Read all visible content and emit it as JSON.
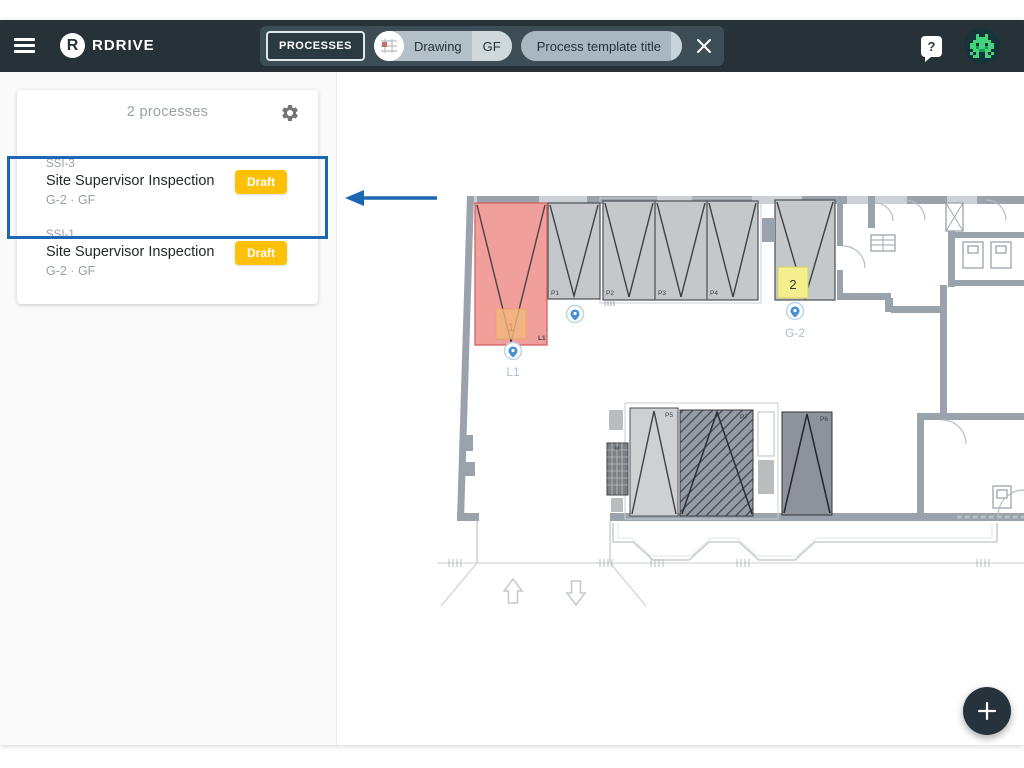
{
  "topbar": {
    "brand": "RDRIVE",
    "brand_initial": "R",
    "processes_button_label": "PROCESSES",
    "drawing_chip": {
      "label": "Drawing",
      "floor": "GF"
    },
    "template_chip": {
      "label": "Process template title"
    },
    "help_glyph": "?"
  },
  "sidebar": {
    "header": {
      "count_label": "2 processes"
    },
    "items": [
      {
        "code": "SSI-3",
        "title": "Site Supervisor Inspection",
        "status": "Draft",
        "location": "G-2 · GF"
      },
      {
        "code": "SSI-1",
        "title": "Site Supervisor Inspection",
        "status": "Draft",
        "location": "G-2 · GF"
      }
    ]
  },
  "plan": {
    "rooms": {
      "l1_label": "L1"
    },
    "notes": {
      "note1": "1",
      "note2": "2"
    },
    "pins": {
      "l1": "L1",
      "g2": "G-2"
    },
    "stalls": {
      "p1": "P1",
      "p2": "P2",
      "p3": "P3",
      "p4": "P4",
      "p5": "P5",
      "p6": "P6",
      "p7": "P7",
      "m": "M"
    }
  },
  "colors": {
    "topbar_bg": "#263238",
    "accent_blue": "#1c67b4",
    "badge_amber": "#ffc107",
    "highlight_red": "#f09792",
    "note_yellow": "#f4ee8d",
    "note_orange": "#f2b97c"
  }
}
